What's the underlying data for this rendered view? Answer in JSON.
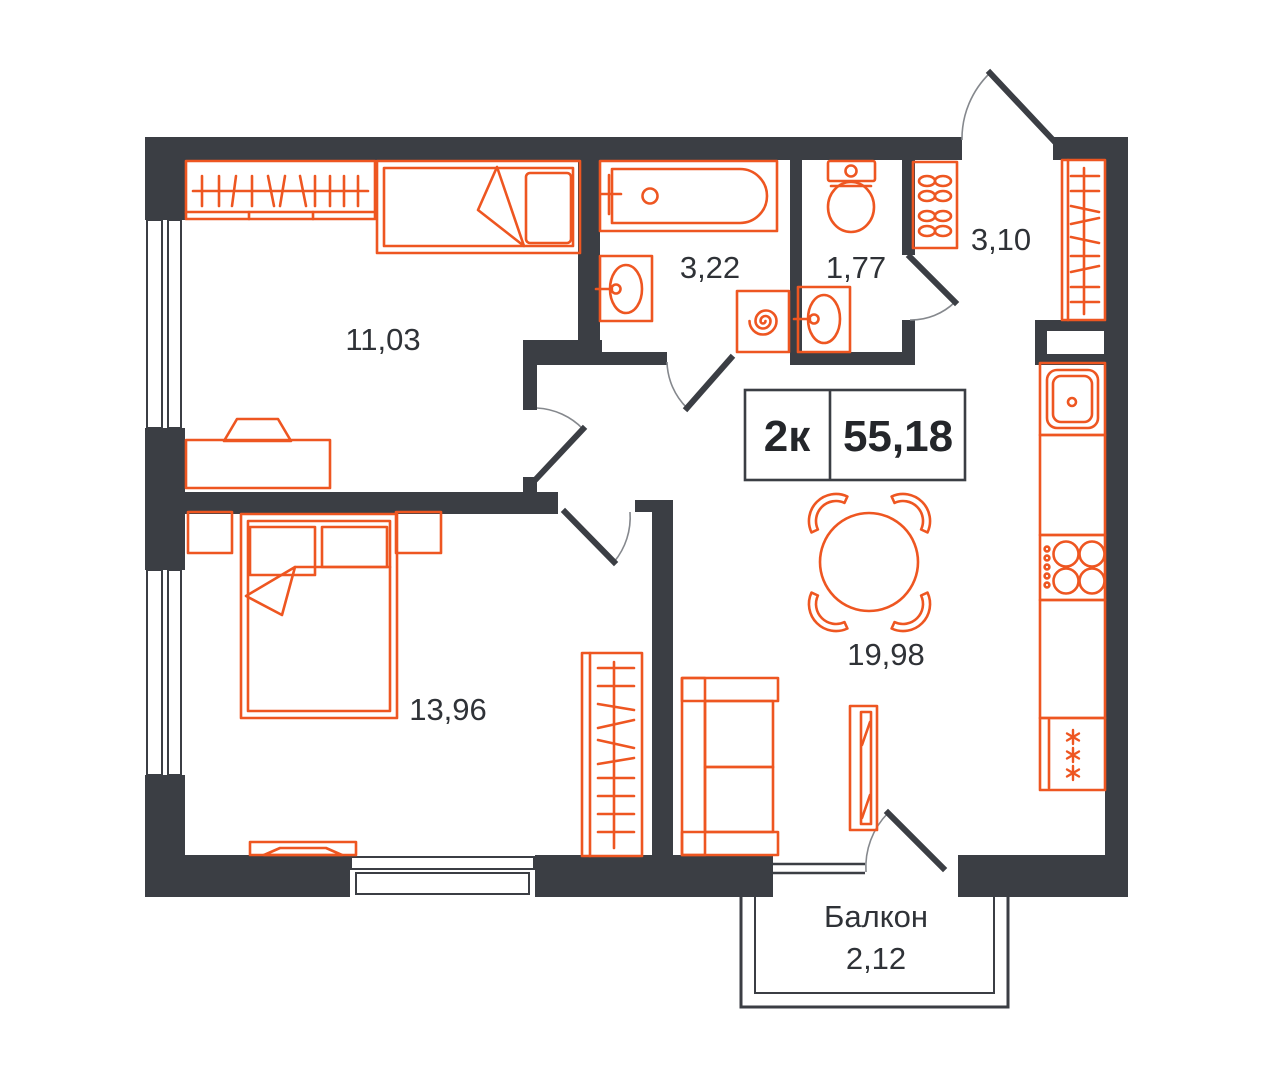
{
  "plan": {
    "info_box": {
      "unit_type": "2к",
      "total_area": "55,18"
    },
    "rooms": {
      "room1": {
        "area": "11,03"
      },
      "bathroom": {
        "area": "3,22"
      },
      "wc": {
        "area": "1,77"
      },
      "hallway": {
        "area": "3,10"
      },
      "kitchen_living": {
        "area": "19,98"
      },
      "bedroom": {
        "area": "13,96"
      },
      "balcony": {
        "name": "Балкон",
        "area": "2,12"
      }
    },
    "colors": {
      "wall": "#3b3e44",
      "accent": "#ee5621",
      "label_text": "#2f3237"
    }
  }
}
